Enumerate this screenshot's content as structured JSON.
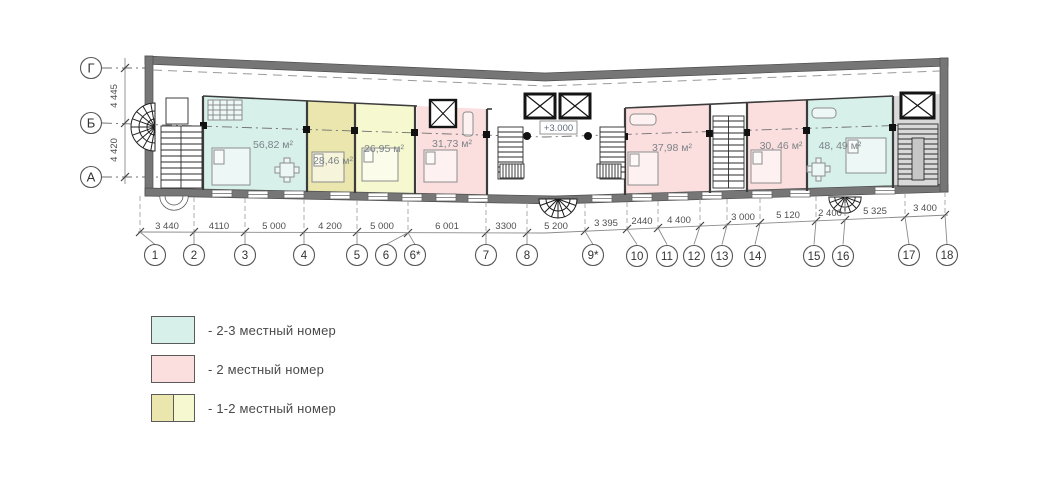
{
  "plan": {
    "level_marker": "+3.000",
    "axes_left": [
      "Г",
      "Б",
      "А"
    ],
    "dims_left": [
      "4 445",
      "4 420"
    ],
    "axes_bottom": [
      "1",
      "2",
      "3",
      "4",
      "5",
      "6",
      "6*",
      "7",
      "8",
      "9*",
      "10",
      "11",
      "12",
      "13",
      "14",
      "15",
      "16",
      "17",
      "18"
    ],
    "dims_bottom": [
      "3 440",
      "4110",
      "5 000",
      "4 200",
      "5 000",
      "6 001",
      "3300",
      "5 200",
      "3 395",
      "2440",
      "4 400",
      "3 000",
      "5 120",
      "2 400",
      "5 325",
      "3 400"
    ],
    "rooms": [
      {
        "id": "room-1",
        "area": "56,82 м²",
        "type": "2-3 местный номер"
      },
      {
        "id": "room-2",
        "area": "28,46 м²",
        "type": "1-2 местный номер"
      },
      {
        "id": "room-3",
        "area": "26,95 м²",
        "type": "1-2 местный номер"
      },
      {
        "id": "room-4",
        "area": "31,73 м²",
        "type": "2 местный номер"
      },
      {
        "id": "room-5",
        "area": "37,98 м²",
        "type": "2 местный номер"
      },
      {
        "id": "room-6",
        "area": "30, 46 м²",
        "type": "2 местный номер"
      },
      {
        "id": "room-7",
        "area": "48, 49 м²",
        "type": "2-3 местный номер"
      }
    ],
    "colors": {
      "room_2_3_places": "#d7f0ea",
      "room_2_places": "#fbdfdf",
      "room_1_2_places_dark": "#eae6ad",
      "room_1_2_places_light": "#f6f8d0",
      "wall": "#767676",
      "stair_zone": "#d9d9d9"
    }
  },
  "legend": {
    "items": [
      {
        "label": "- 2-3 местный номер",
        "color": "#d7f0ea"
      },
      {
        "label": "- 2 местный номер",
        "color": "#fbdfdf"
      },
      {
        "label": "- 1-2 местный номер",
        "color_left": "#eae6ad",
        "color_right": "#f6f8d0"
      }
    ]
  }
}
